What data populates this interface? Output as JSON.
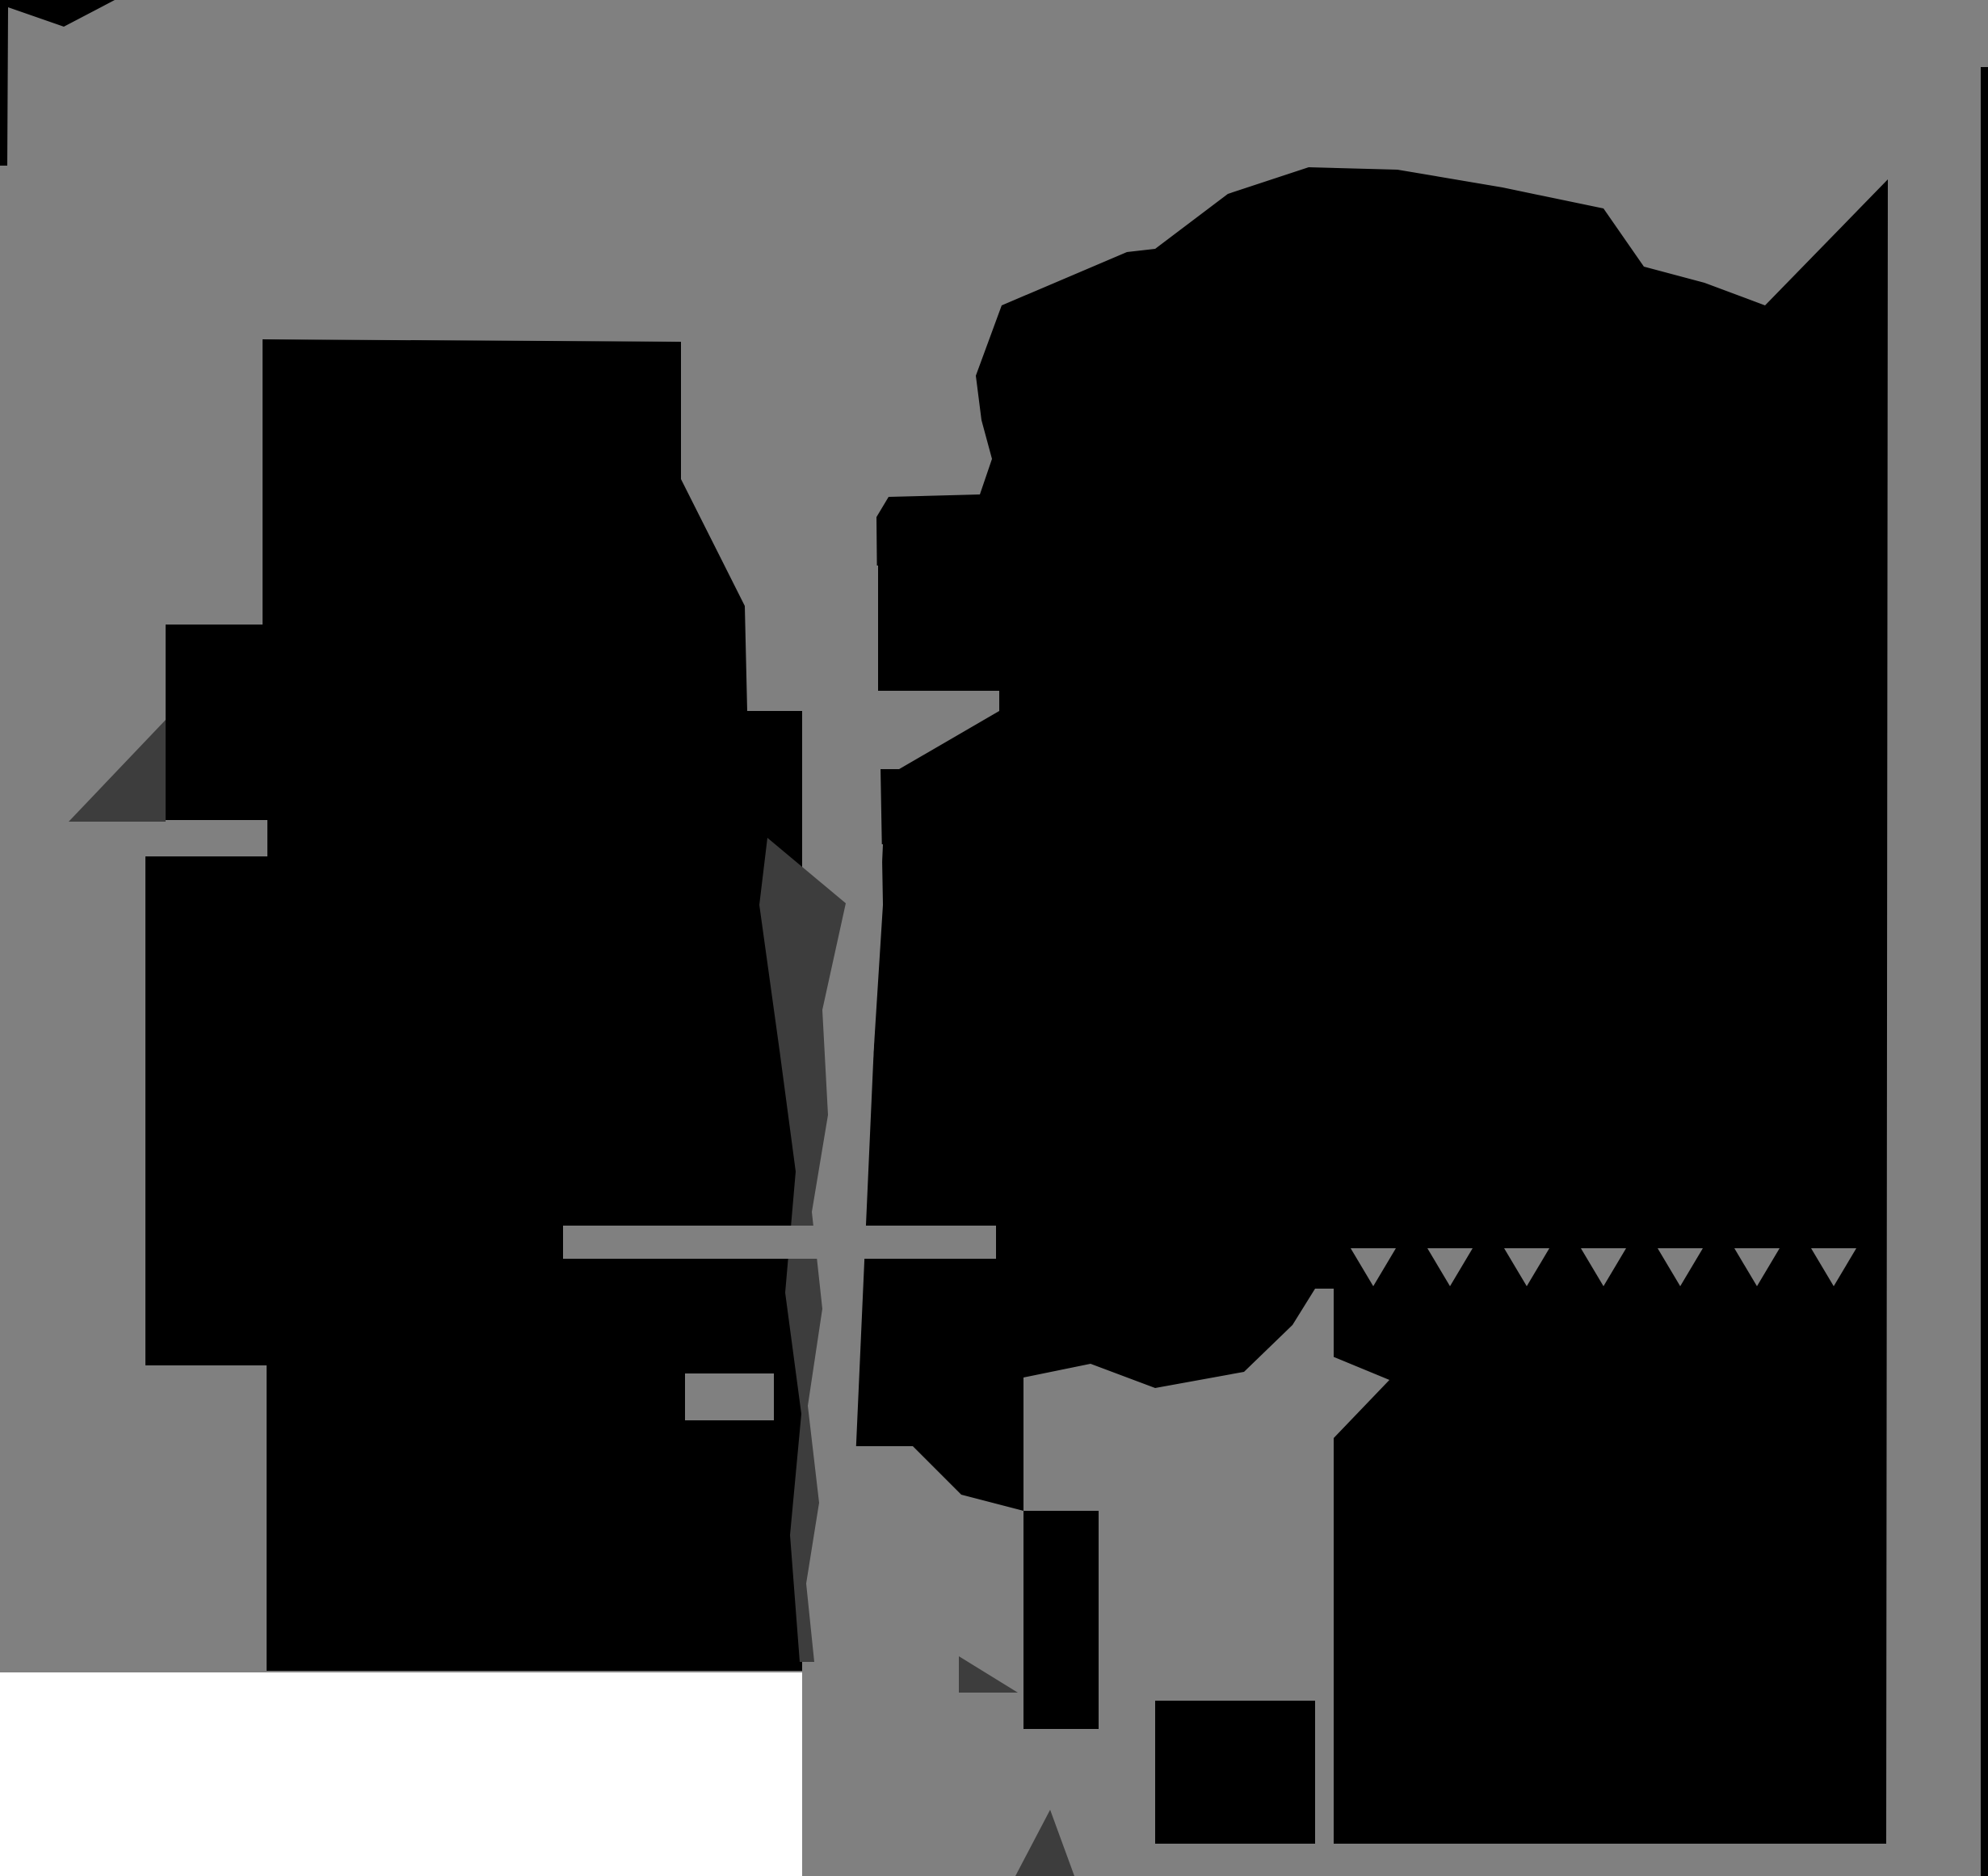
{
  "image": {
    "kind": "abstract-posterized-silhouette",
    "tones": 4
  },
  "palette": {
    "background_gray": "#808080",
    "silhouette_black": "#000000",
    "accent_dark_gray": "#3d3d3d",
    "bottom_white": "#ffffff"
  },
  "shapes": {
    "background": {
      "fill_key": "background_gray"
    },
    "flag_top_left": {
      "fill_key": "silhouette_black"
    },
    "monitor_block": {
      "fill_key": "silhouette_black"
    },
    "left_lower_mass": {
      "fill_key": "silhouette_black"
    },
    "right_mass": {
      "fill_key": "silhouette_black"
    },
    "right_edge_sliver": {
      "fill_key": "silhouette_black"
    },
    "shadow_wedge_left": {
      "fill_key": "accent_dark_gray"
    },
    "zipper_strip": {
      "fill_key": "accent_dark_gray"
    },
    "dark_triangle_bottom_center": {
      "fill_key": "accent_dark_gray"
    },
    "dark_slash_bottom": {
      "fill_key": "accent_dark_gray"
    },
    "channel_block": {
      "fill_key": "background_gray"
    },
    "channel_arm": {
      "fill_key": "background_gray"
    },
    "channel_arm_wedge": {
      "fill_key": "background_gray"
    },
    "center_column": {
      "fill_key": "background_gray"
    },
    "cross_arm": {
      "fill_key": "background_gray"
    },
    "small_bar": {
      "fill_key": "background_gray"
    },
    "funnel_gray": {
      "fill_key": "background_gray"
    },
    "bottom_center_gray_strip": {
      "fill_key": "background_gray"
    },
    "lower_right_gray_region": {
      "fill_key": "background_gray"
    },
    "window_slit": {
      "fill_key": "background_gray"
    },
    "window_wedge": {
      "fill_key": "background_gray"
    },
    "crack_tooth_1": {
      "fill_key": "background_gray"
    },
    "crack_tooth_2": {
      "fill_key": "background_gray"
    },
    "crack_tooth_3": {
      "fill_key": "background_gray"
    },
    "crack_tooth_4": {
      "fill_key": "background_gray"
    },
    "crack_tooth_5": {
      "fill_key": "background_gray"
    },
    "crack_tooth_6": {
      "fill_key": "background_gray"
    },
    "crack_tooth_7": {
      "fill_key": "background_gray"
    },
    "black_patch_notch": {
      "fill_key": "silhouette_black"
    },
    "black_patch_bottom": {
      "fill_key": "silhouette_black"
    },
    "white_bottom_strip": {
      "fill_key": "bottom_white"
    }
  }
}
